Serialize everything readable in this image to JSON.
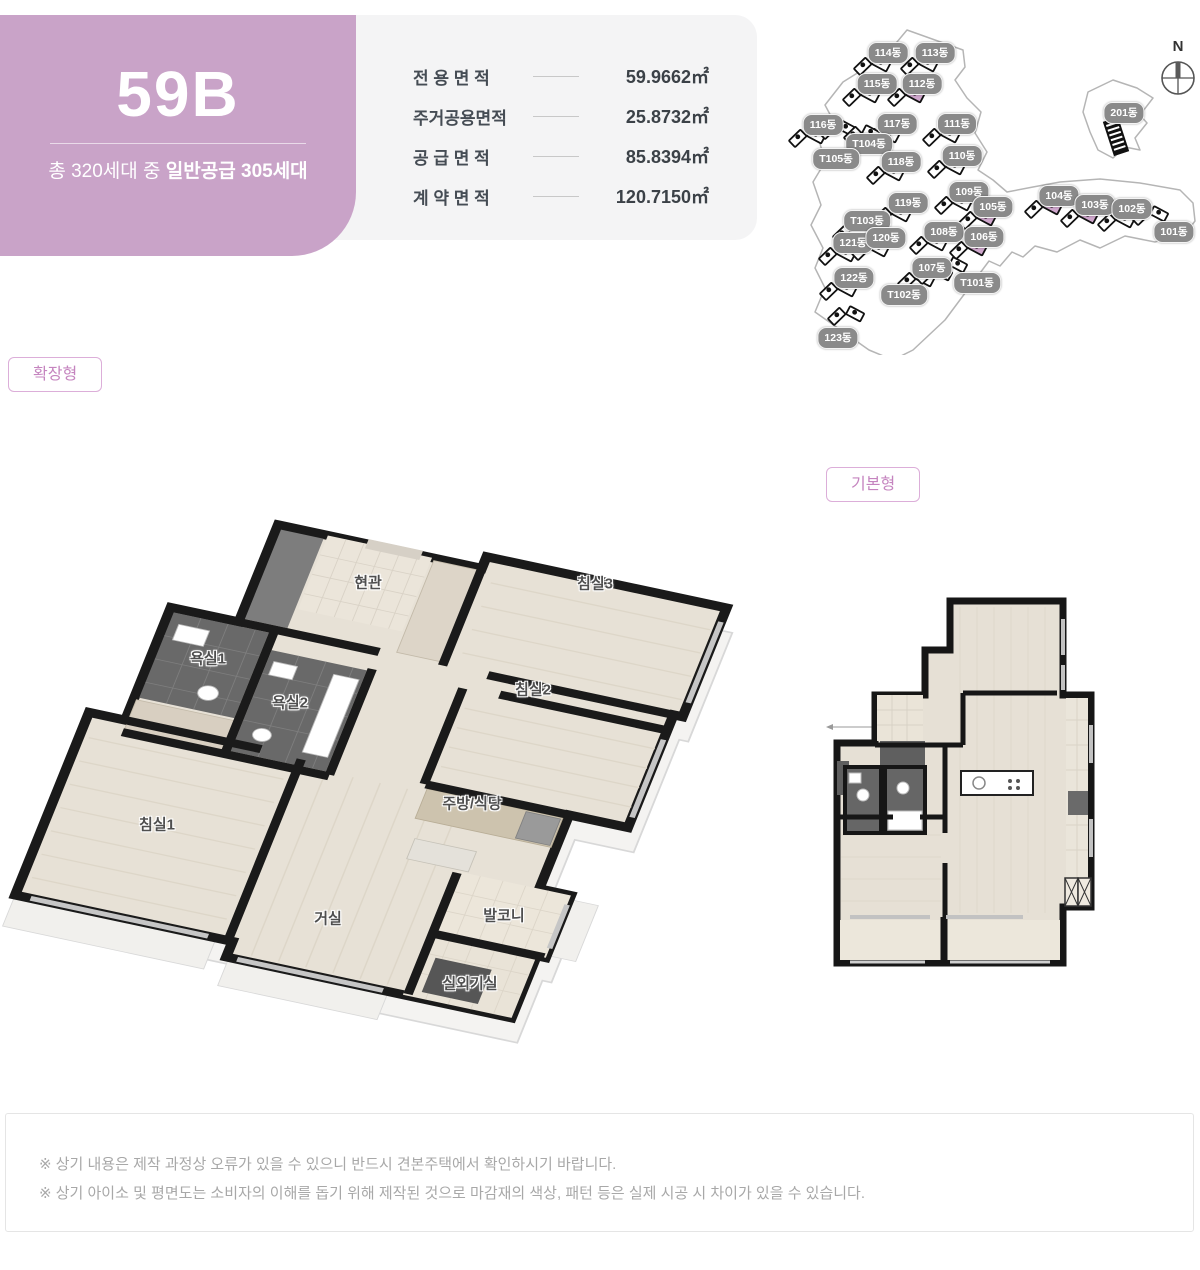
{
  "header": {
    "unit_code": "59B",
    "subtitle_prefix": "총 320세대 중 ",
    "subtitle_bold": "일반공급 305세대"
  },
  "area_table": {
    "rows": [
      {
        "label": "전 용 면 적",
        "value": "59.9662㎡"
      },
      {
        "label": "주거공용면적",
        "value": "25.8732㎡"
      },
      {
        "label": "공 급 면 적",
        "value": "85.8394㎡"
      },
      {
        "label": "계 약 면 적",
        "value": "120.7150㎡"
      }
    ]
  },
  "site_map": {
    "compass_label": "N",
    "buildings": [
      {
        "name": "114동",
        "x": 93,
        "y": 33
      },
      {
        "name": "113동",
        "x": 140,
        "y": 33
      },
      {
        "name": "115동",
        "x": 82,
        "y": 64
      },
      {
        "name": "112동",
        "x": 127,
        "y": 64,
        "highlight": true
      },
      {
        "name": "116동",
        "x": 28,
        "y": 105
      },
      {
        "name": "117동",
        "x": 102,
        "y": 104
      },
      {
        "name": "111동",
        "x": 162,
        "y": 104
      },
      {
        "name": "T104동",
        "x": 74,
        "y": 124,
        "icon_dx": -32,
        "icon_dy": -12
      },
      {
        "name": "T105동",
        "x": 41,
        "y": 139,
        "icon_dx": 26,
        "icon_dy": -22
      },
      {
        "name": "118동",
        "x": 106,
        "y": 142
      },
      {
        "name": "110동",
        "x": 167,
        "y": 136
      },
      {
        "name": "201동",
        "x": 329,
        "y": 93,
        "type": "tower",
        "icon_dx": -8,
        "icon_dy": 26
      },
      {
        "name": "109동",
        "x": 174,
        "y": 172
      },
      {
        "name": "104동",
        "x": 264,
        "y": 176,
        "highlight": true
      },
      {
        "name": "105동",
        "x": 198,
        "y": 187,
        "highlight": true
      },
      {
        "name": "103동",
        "x": 300,
        "y": 185,
        "highlight": true
      },
      {
        "name": "102동",
        "x": 337,
        "y": 189
      },
      {
        "name": "119동",
        "x": 113,
        "y": 183
      },
      {
        "name": "T103동",
        "x": 72,
        "y": 201
      },
      {
        "name": "101동",
        "x": 379,
        "y": 212,
        "icon_dx": -24,
        "icon_dy": -14
      },
      {
        "name": "121동",
        "x": 58,
        "y": 223
      },
      {
        "name": "120동",
        "x": 91,
        "y": 218
      },
      {
        "name": "108동",
        "x": 149,
        "y": 212
      },
      {
        "name": "106동",
        "x": 189,
        "y": 217,
        "highlight": true
      },
      {
        "name": "122동",
        "x": 59,
        "y": 258
      },
      {
        "name": "107동",
        "x": 137,
        "y": 248
      },
      {
        "name": "T101동",
        "x": 182,
        "y": 263,
        "icon_dx": -28,
        "icon_dy": -14
      },
      {
        "name": "T102동",
        "x": 109,
        "y": 275,
        "icon_dx": 30,
        "icon_dy": -18
      },
      {
        "name": "123동",
        "x": 43,
        "y": 318,
        "icon_dx": 8,
        "icon_dy": -20
      }
    ]
  },
  "plan_tags": {
    "expanded": "확장형",
    "basic": "기본형"
  },
  "iso_plan": {
    "rooms": [
      {
        "name": "현관",
        "x": 368,
        "y": 582
      },
      {
        "name": "침실3",
        "x": 595,
        "y": 583
      },
      {
        "name": "욕실1",
        "x": 208,
        "y": 658
      },
      {
        "name": "욕실2",
        "x": 290,
        "y": 702
      },
      {
        "name": "침실2",
        "x": 533,
        "y": 689
      },
      {
        "name": "침실1",
        "x": 157,
        "y": 824
      },
      {
        "name": "주방/식당",
        "x": 472,
        "y": 803
      },
      {
        "name": "거실",
        "x": 328,
        "y": 918
      },
      {
        "name": "발코니",
        "x": 504,
        "y": 915
      },
      {
        "name": "실외기실",
        "x": 470,
        "y": 983
      }
    ]
  },
  "notes": {
    "line1": "※ 상기 내용은 제작 과정상 오류가 있을 수 있으니 반드시 견본주택에서 확인하시기 바랍니다.",
    "line2": "※ 상기 아이소 및 평면도는 소비자의 이해를 돕기 위해 제작된 것으로 마감재의 색상, 패턴 등은 실제 시공 시 차이가 있을 수 있습니다."
  },
  "colors": {
    "accent_purple": "#c9a3c8",
    "highlight_purple": "#cfa6cc",
    "pill_gray": "#8a8a8a",
    "tag_text": "#c584bf"
  }
}
